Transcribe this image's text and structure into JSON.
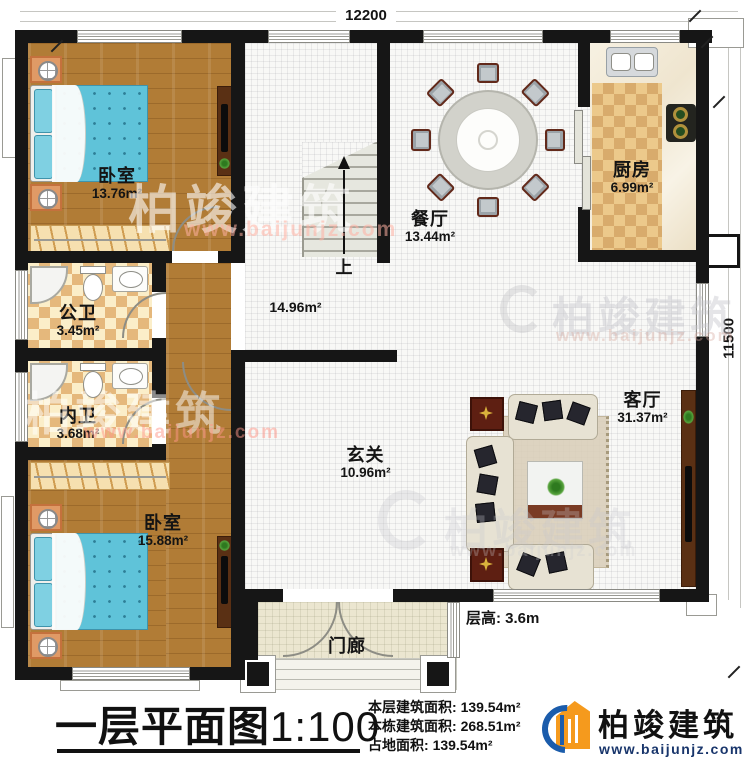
{
  "dimensions": {
    "width_top": "12200",
    "height_right": "11500"
  },
  "rooms": {
    "bedroom1": {
      "label": "卧室",
      "area": "13.76m²"
    },
    "dining": {
      "label": "餐厅",
      "area": "13.44m²"
    },
    "kitchen": {
      "label": "厨房",
      "area": "6.99m²"
    },
    "bath_public": {
      "label": "公卫",
      "area": "3.45m²"
    },
    "bath_private": {
      "label": "内卫",
      "area": "3.68m²"
    },
    "bedroom2": {
      "label": "卧室",
      "area": "15.88m²"
    },
    "foyer": {
      "label": "玄关",
      "area": "10.96m²"
    },
    "living": {
      "label": "客厅",
      "area": "31.37m²"
    },
    "porch": {
      "label": "门廊"
    },
    "hall": {
      "area": "14.96m²"
    }
  },
  "stairs": {
    "up_label": "上"
  },
  "floor_height_note": "层高: 3.6m",
  "footer": {
    "title": "一层平面图",
    "scale": "1:100",
    "stats": [
      {
        "label": "本层建筑面积:",
        "value": "139.54m²"
      },
      {
        "label": "本栋建筑面积:",
        "value": "268.51m²"
      },
      {
        "label": "占地面积:",
        "value": "139.54m²"
      }
    ],
    "brand_name": "柏竣建筑",
    "brand_url": "www.baijunjz.com"
  },
  "watermark": {
    "name": "柏竣建筑",
    "url": "www.baijunjz.com"
  }
}
